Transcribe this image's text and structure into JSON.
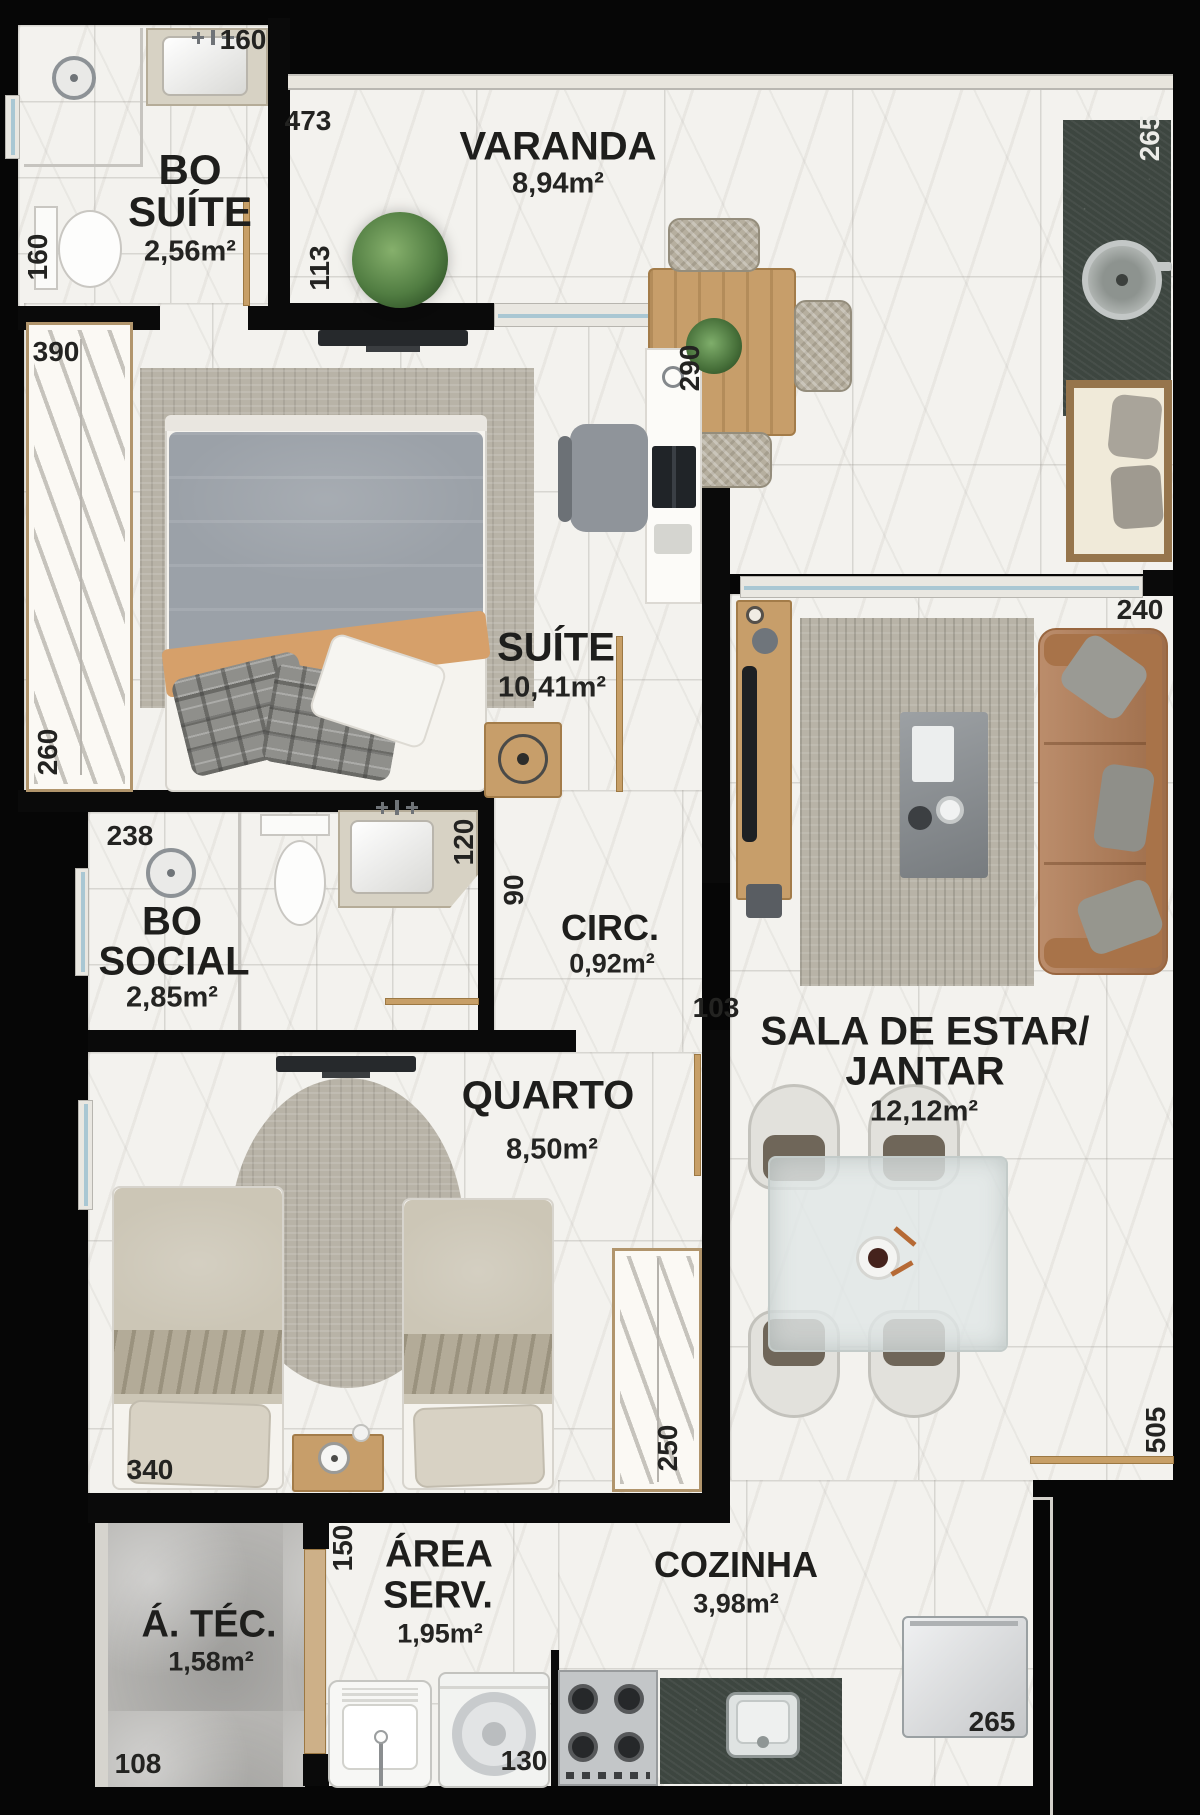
{
  "rooms": {
    "bo_suite": {
      "line1": "BO",
      "line2": "SUÍTE",
      "area": "2,56m²"
    },
    "varanda": {
      "line1": "VARANDA",
      "area": "8,94m²"
    },
    "suite": {
      "line1": "SUÍTE",
      "area": "10,41m²"
    },
    "bo_social": {
      "line1": "BO",
      "line2": "SOCIAL",
      "area": "2,85m²"
    },
    "circ": {
      "line1": "CIRC.",
      "area": "0,92m²"
    },
    "sala": {
      "line1": "SALA DE ESTAR/",
      "line2": "JANTAR",
      "area": "12,12m²"
    },
    "quarto": {
      "line1": "QUARTO",
      "area": "8,50m²"
    },
    "area_serv": {
      "line1": "ÁREA",
      "line2": "SERV.",
      "area": "1,95m²"
    },
    "cozinha": {
      "line1": "COZINHA",
      "area": "3,98m²"
    },
    "a_tec": {
      "line1": "Á. TÉC.",
      "area": "1,58m²"
    }
  },
  "dims": {
    "bo_suite_sink": "160",
    "bo_suite_left": "160",
    "varanda_top": "473",
    "varanda_plant": "113",
    "varanda_counter": "265",
    "suite_wardrobe_top": "390",
    "suite_window": "290",
    "suite_wardrobe_side": "260",
    "bo_social_top": "238",
    "bo_social_side": "120",
    "circ_width": "90",
    "quarto_door": "103",
    "sala_window": "240",
    "quarto_width": "340",
    "quarto_wardrobe": "250",
    "sala_side": "505",
    "area_serv_side": "150",
    "washer_width": "130",
    "a_tec_width": "108",
    "kitchen_counter": "265"
  },
  "colors": {
    "wall": "#0a0a0a",
    "marble_floor": "#f3f2ee",
    "technical_floor": "#b6b5b2",
    "counter_green": "#3d4640",
    "wood": "#c79e6a",
    "sofa_leather": "#b07a53",
    "window_glass": "#a9c7d3"
  }
}
